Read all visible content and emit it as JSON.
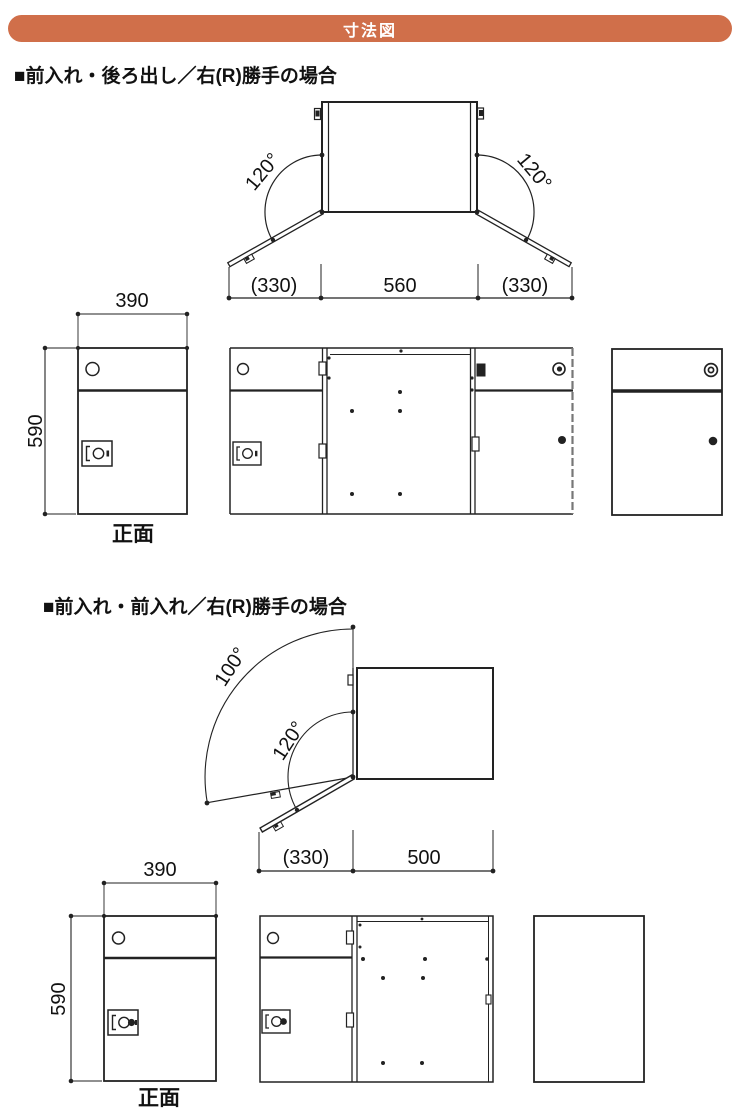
{
  "header": {
    "title": "寸法図"
  },
  "colors": {
    "accent": "#d06f4a",
    "line": "#222222"
  },
  "sections": [
    {
      "heading": "■前入れ・後ろ出し／右(R)勝手の場合",
      "top_view": {
        "angle_left": "120°",
        "angle_right": "120°",
        "dims": {
          "left": "(330)",
          "center": "560",
          "right": "(330)"
        }
      },
      "front_view": {
        "width": "390",
        "height": "590",
        "caption": "正面"
      }
    },
    {
      "heading": "■前入れ・前入れ／右(R)勝手の場合",
      "top_view": {
        "angle_outer": "100°",
        "angle_inner": "120°",
        "dims": {
          "left": "(330)",
          "right": "500"
        }
      },
      "front_view": {
        "width": "390",
        "height": "590",
        "caption": "正面"
      }
    }
  ]
}
